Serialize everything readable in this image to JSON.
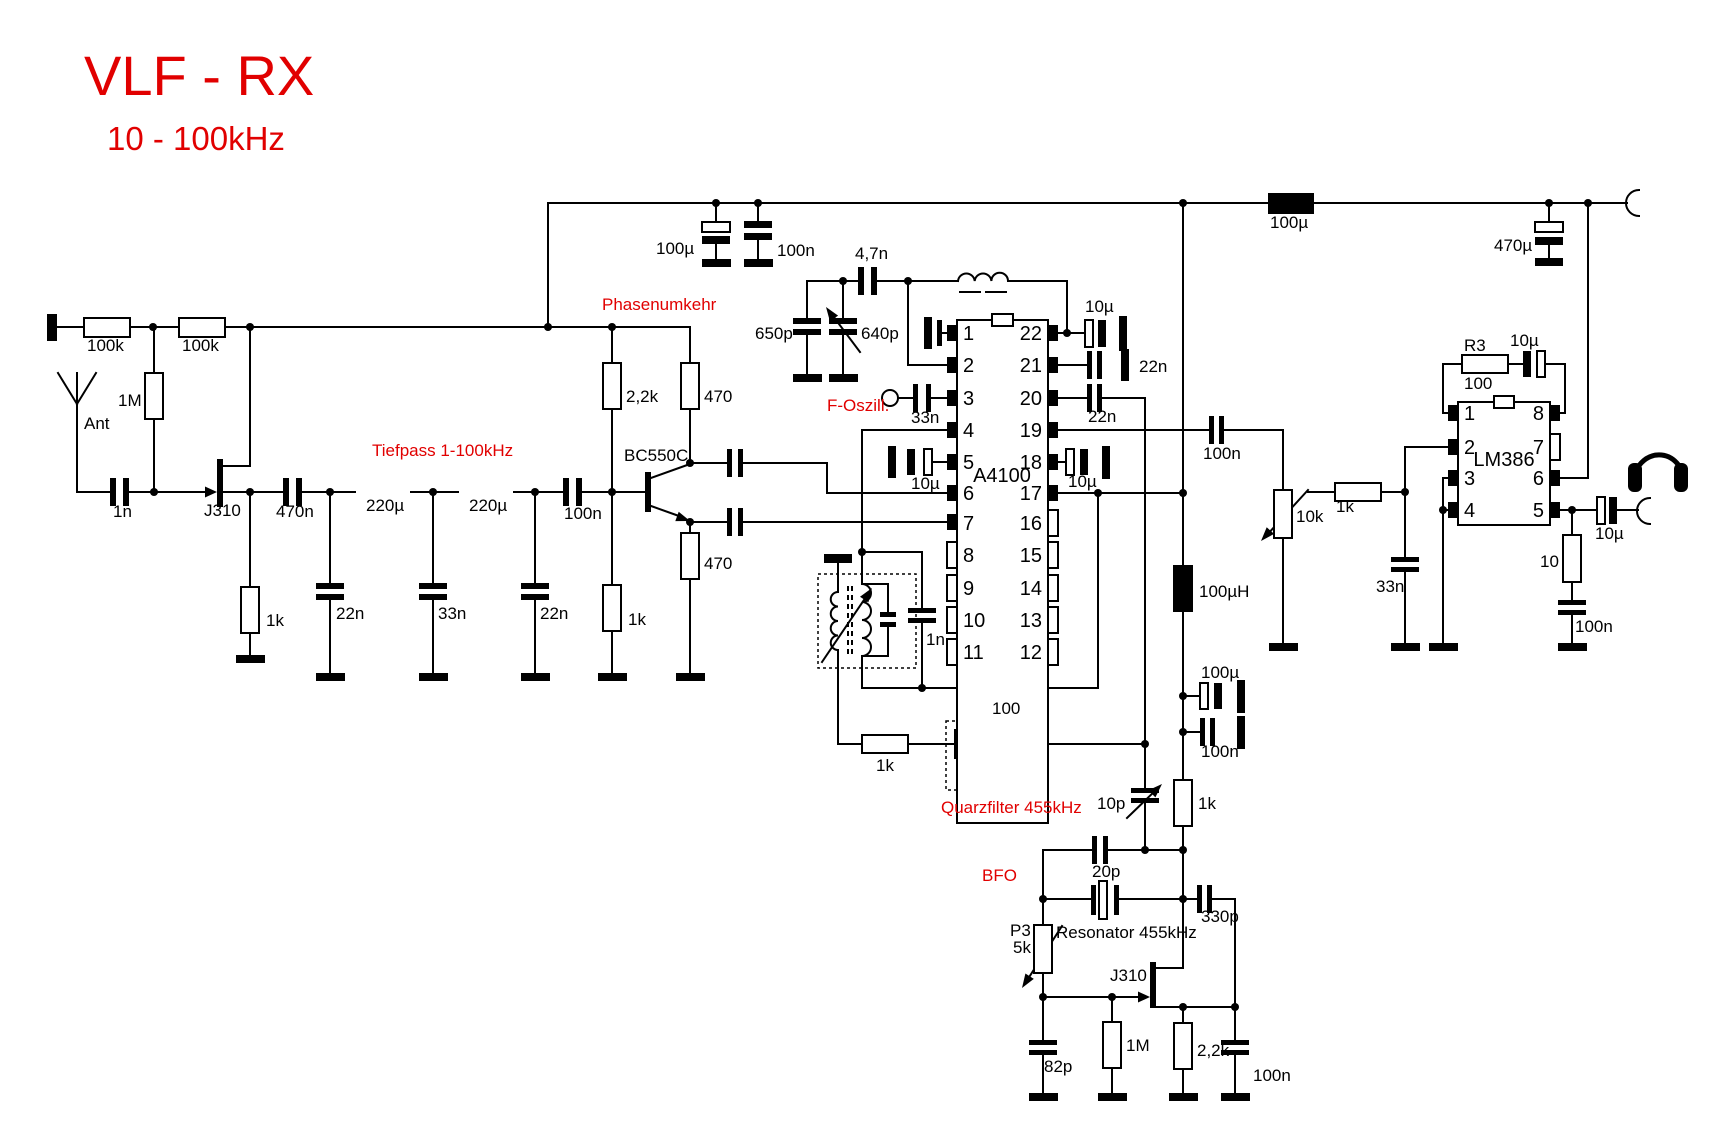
{
  "title": {
    "main": "VLF - RX",
    "subtitle": "10 - 100kHz"
  },
  "sections": {
    "tiefpass": "Tiefpass 1-100kHz",
    "phasenumkehr": "Phasenumkehr",
    "f_oszill": "F-Oszill.",
    "quarzfilter": "Quarzfilter 455kHz",
    "bfo": "BFO",
    "resonator": "Resonator 455kHz"
  },
  "ics": {
    "a4100": {
      "name": "A4100",
      "pins_left": [
        "1",
        "2",
        "3",
        "4",
        "5",
        "6",
        "7",
        "8",
        "9",
        "10",
        "11"
      ],
      "pins_right": [
        "22",
        "21",
        "20",
        "19",
        "18",
        "17",
        "16",
        "15",
        "14",
        "13",
        "12"
      ]
    },
    "lm386": {
      "name": "LM386",
      "pins_left": [
        "1",
        "2",
        "3",
        "4"
      ],
      "pins_right": [
        "8",
        "7",
        "6",
        "5"
      ]
    }
  },
  "parts": {
    "r100k_a": "100k",
    "r100k_b": "100k",
    "r1m_in": "1M",
    "ant": "Ant",
    "c1n_in": "1n",
    "j310_rf": "J310",
    "c470n": "470n",
    "r1k_src": "1k",
    "c22n_a": "22n",
    "l220u_a": "220µ",
    "c33n_lp": "33n",
    "l220u_b": "220µ",
    "c22n_b": "22n",
    "c100n_cpl": "100n",
    "r2k2_ph": "2,2k",
    "r470_c": "470",
    "bc550c": "BC550C",
    "r1k_ph": "1k",
    "r470_e": "470",
    "c100u_ps": "100µ",
    "c100n_ps": "100n",
    "c650p": "650p",
    "c640p": "640p",
    "c4n7": "4,7n",
    "c33n_osc": "33n",
    "c10u_p5": "10µ",
    "c1n_det": "1n",
    "r100_det": "100",
    "r1k_qf": "1k",
    "c10u_p22": "10µ",
    "c22n_p21": "22n",
    "c22n_p20": "22n",
    "c10u_p18": "10µ",
    "l100u_rail": "100µ",
    "c100n_p19": "100n",
    "l100uh": "100µH",
    "c100u_dec": "100µ",
    "c100n_dec": "100n",
    "r1k_bfo": "1k",
    "c10p": "10p",
    "c20p": "20p",
    "c330p": "330p",
    "p3_name": "P3",
    "p3_val": "5k",
    "j310_bfo": "J310",
    "c82p": "82p",
    "r1m_bfo": "1M",
    "r2k2_bfo": "2,2k",
    "c100n_bfo": "100n",
    "pot10k": "10k",
    "r1k_af": "1k",
    "c33n_af": "33n",
    "r3_name": "R3",
    "r3_val": "100",
    "c10u_fb": "10µ",
    "c470u": "470µ",
    "c10u_out": "10µ",
    "r10_out": "10",
    "c100n_out": "100n"
  },
  "colors": {
    "accent_red": "#e10000",
    "line": "#000000",
    "background": "#ffffff"
  }
}
